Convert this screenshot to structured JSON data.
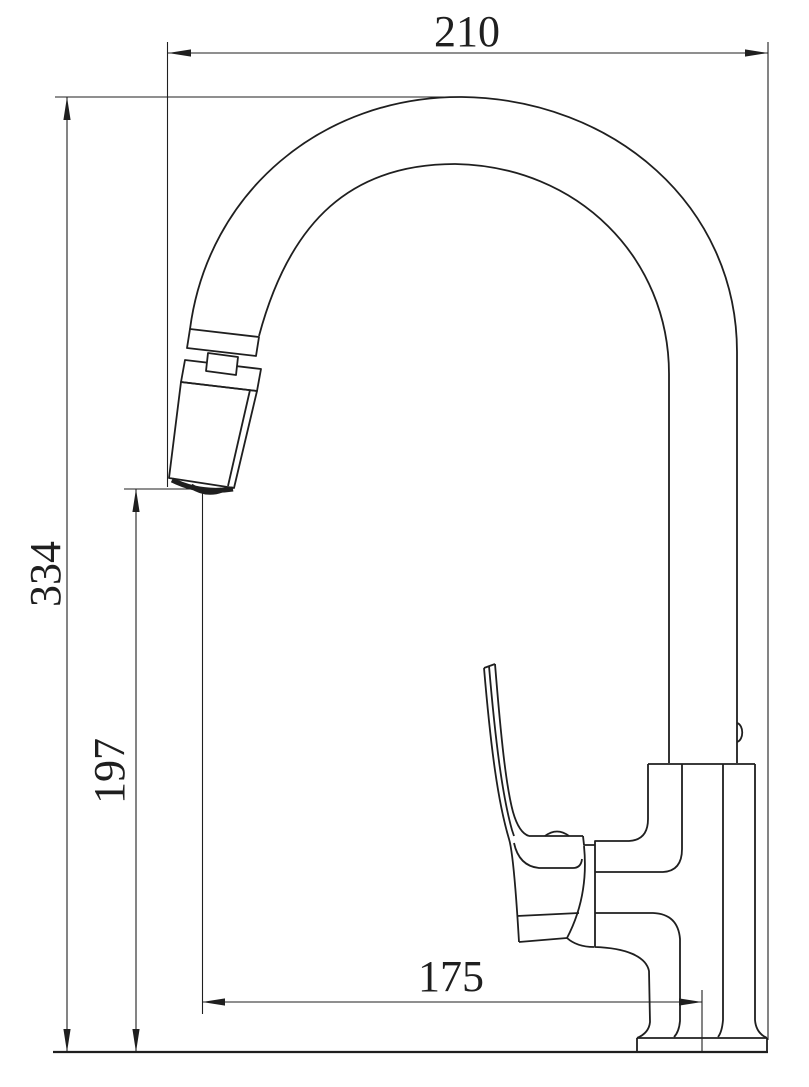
{
  "drawing": {
    "type": "faucet-dimension-drawing",
    "background_color": "#ffffff",
    "line_color": "#1f1f1f",
    "dimensions": {
      "spout_width": {
        "value": "210",
        "orientation": "horizontal",
        "position": "top"
      },
      "total_height": {
        "value": "334",
        "orientation": "vertical",
        "position": "left-outer"
      },
      "outlet_height": {
        "value": "197",
        "orientation": "vertical",
        "position": "left-inner"
      },
      "spout_reach": {
        "value": "175",
        "orientation": "horizontal",
        "position": "bottom"
      }
    }
  }
}
